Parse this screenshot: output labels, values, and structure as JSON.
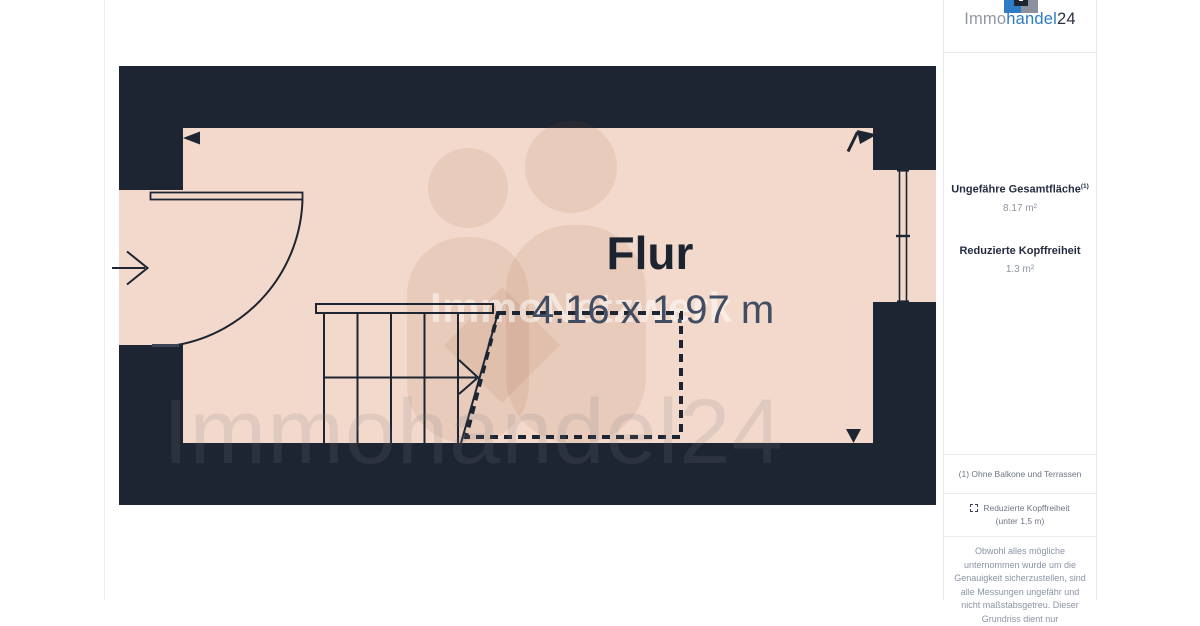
{
  "branding": {
    "logo_immo": "Immo",
    "logo_handel": "handel",
    "logo_24": "24"
  },
  "floor_plan": {
    "room_label": "Flur",
    "room_dimensions": "4.16 x 1.97 m",
    "watermark_center": "ImmoNetzwerk",
    "watermark_large": "Immohandel24"
  },
  "sidebar": {
    "total_area_label": "Ungefähre Gesamtfläche",
    "total_area_sup": "(1)",
    "total_area_value": "8.17 m²",
    "headroom_label": "Reduzierte Kopffreiheit",
    "headroom_value": "1.3 m²",
    "footnote1": "(1) Ohne Balkone und Terrassen",
    "legend_label": "Reduzierte Kopffreiheit",
    "legend_sub": "(unter 1,5 m)",
    "disclaimer": "Obwohl alles mögliche unternommen wurde um die Genauigkeit sicherzustellen, sind alle Messungen ungefähr und nicht maßstabsgetreu. Dieser Grundriss dient nur"
  },
  "colors": {
    "wall": "#1d2532",
    "floor": "#f3d9cb",
    "accent_blue": "#2e7cc4",
    "logo_gray": "#8b919c"
  }
}
